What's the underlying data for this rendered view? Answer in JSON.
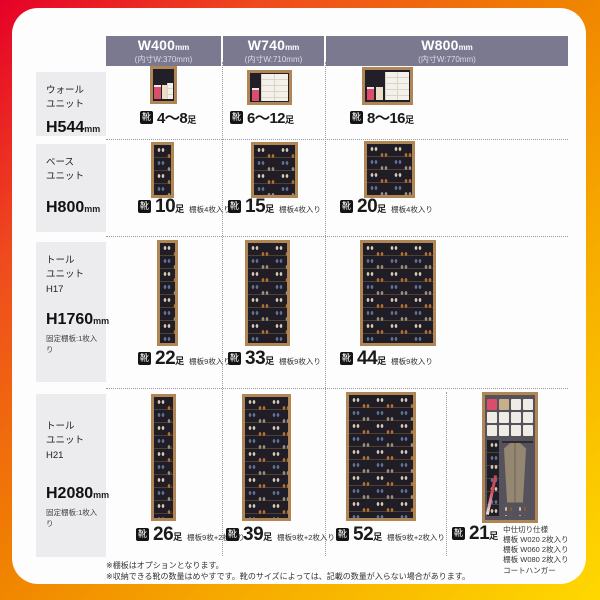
{
  "brand_colors": {
    "header_band": "#7a7990",
    "accent_red": "#e60028",
    "accent_orange": "#f08300",
    "accent_yellow": "#ffd800"
  },
  "columns": [
    {
      "size": "W400",
      "size_unit": "mm",
      "inner": "(内寸W:370mm)"
    },
    {
      "size": "W740",
      "size_unit": "mm",
      "inner": "(内寸W:710mm)"
    },
    {
      "size": "W800",
      "size_unit": "mm",
      "inner": "(内寸W:770mm)"
    }
  ],
  "rows": [
    {
      "name_line1": "ウォール",
      "name_line2": "ユニット",
      "name_line3": "",
      "height": "H544",
      "height_unit": "mm",
      "fixed_note": "",
      "cells": [
        {
          "icon": "靴",
          "capacity": "4〜8",
          "capacity_unit": "足",
          "note": ""
        },
        {
          "icon": "靴",
          "capacity": "6〜12",
          "capacity_unit": "足",
          "note": ""
        },
        {
          "icon": "靴",
          "capacity": "8〜16",
          "capacity_unit": "足",
          "note": ""
        }
      ]
    },
    {
      "name_line1": "ベース",
      "name_line2": "ユニット",
      "name_line3": "",
      "height": "H800",
      "height_unit": "mm",
      "fixed_note": "",
      "cells": [
        {
          "icon": "靴",
          "capacity": "10",
          "capacity_unit": "足",
          "note": "棚板4枚入り"
        },
        {
          "icon": "靴",
          "capacity": "15",
          "capacity_unit": "足",
          "note": "棚板4枚入り"
        },
        {
          "icon": "靴",
          "capacity": "20",
          "capacity_unit": "足",
          "note": "棚板4枚入り"
        }
      ]
    },
    {
      "name_line1": "トール",
      "name_line2": "ユニット",
      "name_line3": "H17",
      "height": "H1760",
      "height_unit": "mm",
      "fixed_note": "固定棚板:1枚入り",
      "cells": [
        {
          "icon": "靴",
          "capacity": "22",
          "capacity_unit": "足",
          "note": "棚板9枚入り"
        },
        {
          "icon": "靴",
          "capacity": "33",
          "capacity_unit": "足",
          "note": "棚板9枚入り"
        },
        {
          "icon": "靴",
          "capacity": "44",
          "capacity_unit": "足",
          "note": "棚板9枚入り"
        }
      ]
    },
    {
      "name_line1": "トール",
      "name_line2": "ユニット",
      "name_line3": "H21",
      "height": "H2080",
      "height_unit": "mm",
      "fixed_note": "固定棚板:1枚入り",
      "cells": [
        {
          "icon": "靴",
          "capacity": "26",
          "capacity_unit": "足",
          "note": "棚板9枚+2枚入り"
        },
        {
          "icon": "靴",
          "capacity": "39",
          "capacity_unit": "足",
          "note": "棚板9枚+2枚入り"
        },
        {
          "icon": "靴",
          "capacity": "52",
          "capacity_unit": "足",
          "note": "棚板9枚+2枚入り"
        },
        {
          "icon": "靴",
          "capacity": "21",
          "capacity_unit": "足",
          "note_lines": [
            "中仕切り仕様",
            "棚板 W020 2枚入り",
            "棚板 W060 2枚入り",
            "棚板 W080 2枚入り",
            "コートハンガー"
          ]
        }
      ]
    }
  ],
  "footnotes": [
    "※棚板はオプションとなります。",
    "※収納できる靴の数量はめやすです。靴のサイズによっては、記載の数量が入らない場合があります。"
  ]
}
